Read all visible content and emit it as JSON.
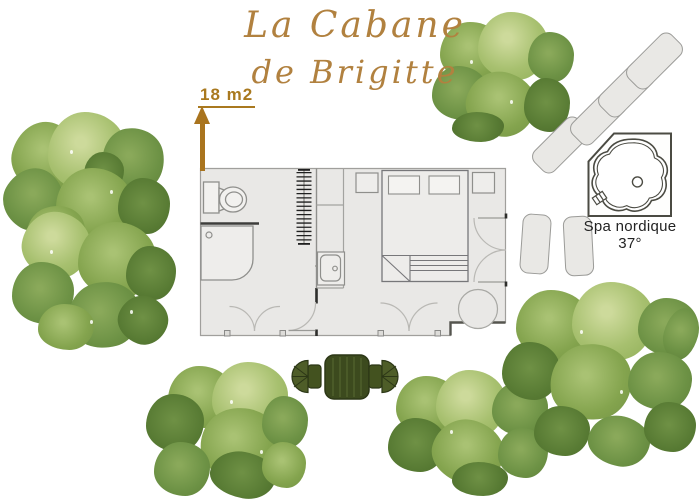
{
  "title": {
    "line1": "La Cabane",
    "line2": "de Brigitte",
    "color": "#b1813f"
  },
  "area_label": {
    "text": "18 m2",
    "color": "#a9791f",
    "arrow_direction": "up",
    "arrow_color": "#a9741e"
  },
  "spa": {
    "label": "Spa nordique",
    "temperature": "37°",
    "outline_color": "#4b4b43"
  },
  "plan": {
    "floor_color": "#e9e8e6",
    "wall_color": "#a09f9c",
    "fixtures": [
      "toilet",
      "shower",
      "radiator",
      "kitchen-counter",
      "sink",
      "double-bed",
      "pillows",
      "nightstand-left",
      "nightstand-right",
      "bathroom-entry-double-door",
      "bedroom-entry-double-door",
      "interior-door",
      "french-doors-right",
      "round-table",
      "corner-step"
    ]
  },
  "outdoor_furniture": {
    "dining_table_color": "#3c4a1e",
    "chair_color": "#4e5d28",
    "lounge_chair_color": "#e9e8e5",
    "diagonal_lounge_chairs": 4,
    "vertical_lounge_chairs": 2
  },
  "trees": {
    "style": "watercolor",
    "palette": [
      "#cdda9b",
      "#8fae57",
      "#6d9245",
      "#577a33",
      "#4e6c2e"
    ]
  }
}
